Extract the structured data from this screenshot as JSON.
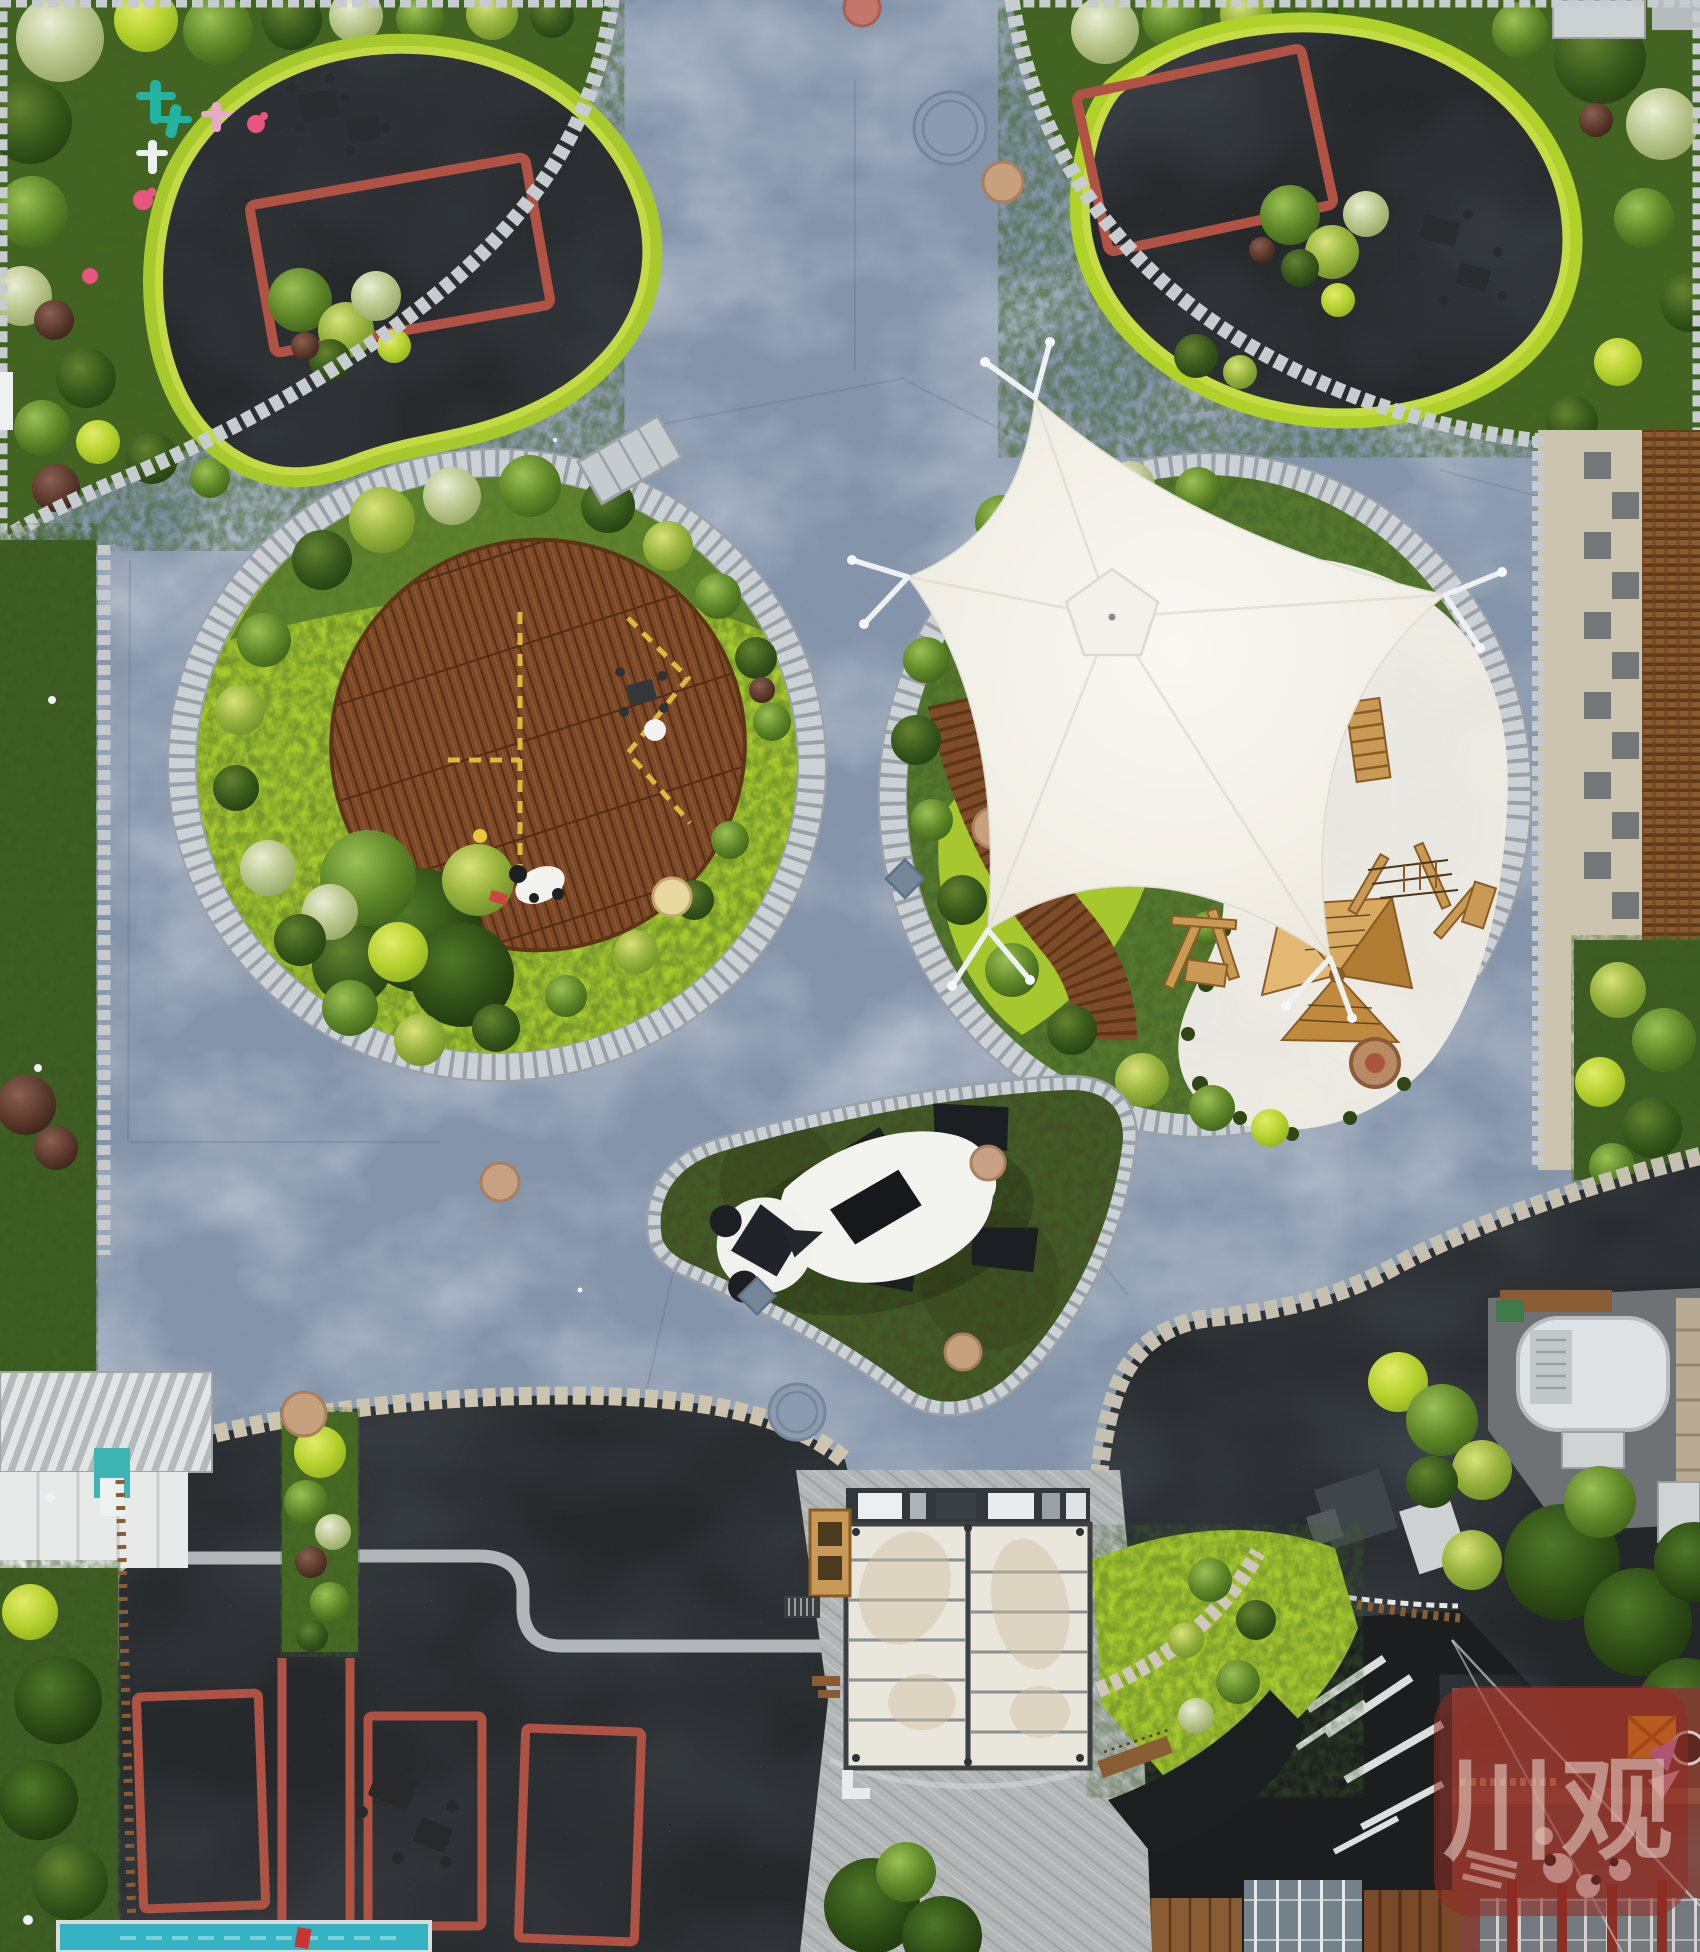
{
  "scene": {
    "title": "aerial-view-panda-theme-plaza",
    "watermark": {
      "text": "川观",
      "bg_color": "rgba(145,42,32,0.55)",
      "text_color": "rgba(228,203,193,0.60)"
    },
    "palette": {
      "plaza": "#8494aa",
      "plaza_light": "#9aa9bc",
      "paver": "#c7ccd1",
      "paver_tan": "#cdc4b0",
      "gravel_dark": "#26292b",
      "asphalt_wet": "#1b1d1f",
      "lime": "#a8c92e",
      "foliage_dark": "#3d5a21",
      "deck_wood": "#7c4827",
      "play_wood": "#c99a56",
      "canopy_white": "#f4f2ec",
      "sand_white": "#efece4",
      "marking_red": "#ae5344",
      "court_red": "#b05244",
      "pool_teal": "#36b3c3",
      "terrace_red": "#7e3f33",
      "panda_black": "#1b1e22",
      "panda_white": "#f3f3f0",
      "roof_white": "#e9e6dc",
      "teal_toy": "#25b2a2",
      "pink_toy": "#e8557e"
    },
    "regions": {
      "top_left_play_area": "black rubber play surface with red court outline",
      "top_right_play_area": "black rubber play surface with red court outline",
      "left_island": "oval island with wooden event deck",
      "right_island": "island with white shade sail and sand play zone",
      "triangle_island": "grass island with reclining panda sculpture",
      "bottom_left_court": "dark court with red markings and pool",
      "bottom_right_works": "service yard, tank and rooftop terrace",
      "service_canopy": "white membrane roof structure"
    }
  }
}
